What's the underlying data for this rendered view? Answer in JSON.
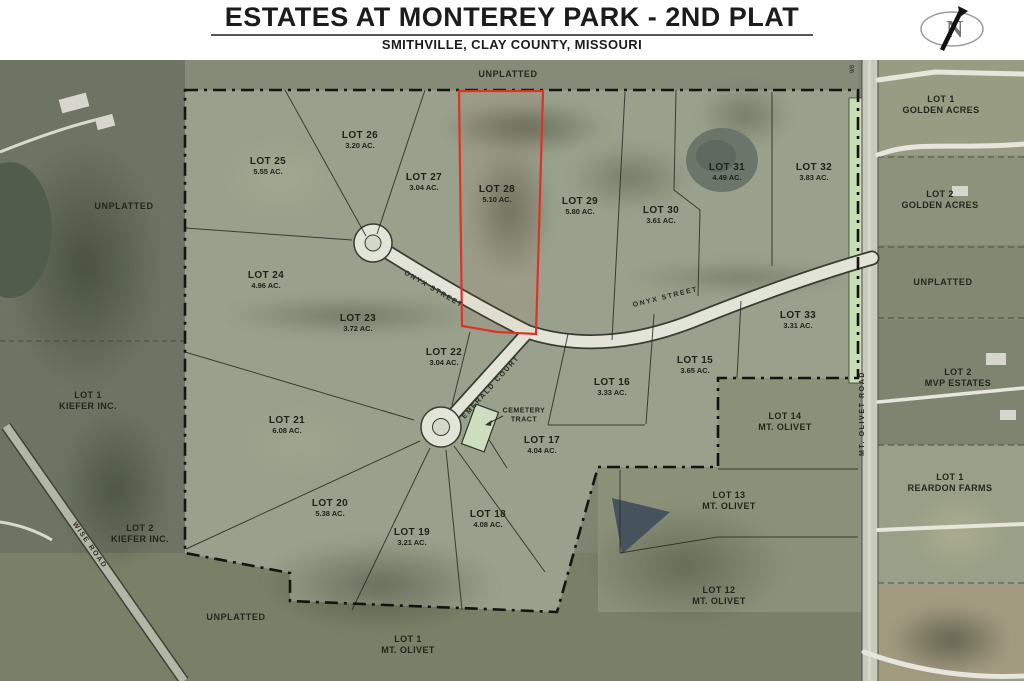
{
  "header": {
    "title": "ESTATES AT MONTEREY PARK - 2ND PLAT",
    "subtitle": "SMITHVILLE, CLAY COUNTY, MISSOURI",
    "compass_letter": "N"
  },
  "map": {
    "highlighted_lot": "LOT 28",
    "lots": [
      {
        "name": "LOT 25",
        "area": "5.55 AC."
      },
      {
        "name": "LOT 26",
        "area": "3.20 AC."
      },
      {
        "name": "LOT 27",
        "area": "3.04 AC."
      },
      {
        "name": "LOT 28",
        "area": "5.10 AC."
      },
      {
        "name": "LOT 29",
        "area": "5.80 AC."
      },
      {
        "name": "LOT 30",
        "area": "3.61 AC."
      },
      {
        "name": "LOT 31",
        "area": "4.49 AC."
      },
      {
        "name": "LOT 32",
        "area": "3.83 AC."
      },
      {
        "name": "LOT 33",
        "area": "3.31 AC."
      },
      {
        "name": "LOT 24",
        "area": "4.96 AC."
      },
      {
        "name": "LOT 23",
        "area": "3.72 AC."
      },
      {
        "name": "LOT 22",
        "area": "3.04 AC."
      },
      {
        "name": "LOT 21",
        "area": "6.08 AC."
      },
      {
        "name": "LOT 20",
        "area": "5.38 AC."
      },
      {
        "name": "LOT 19",
        "area": "3.21 AC."
      },
      {
        "name": "LOT 18",
        "area": "4.08 AC."
      },
      {
        "name": "LOT 17",
        "area": "4.04 AC."
      },
      {
        "name": "LOT 16",
        "area": "3.33 AC."
      },
      {
        "name": "LOT 15",
        "area": "3.65 AC."
      }
    ],
    "outside": [
      {
        "l1": "LOT 14",
        "l2": "MT. OLIVET"
      },
      {
        "l1": "LOT 13",
        "l2": "MT. OLIVET"
      },
      {
        "l1": "LOT 12",
        "l2": "MT. OLIVET"
      },
      {
        "l1": "LOT 1",
        "l2": "MT. OLIVET"
      },
      {
        "l1": "LOT 1",
        "l2": "GOLDEN ACRES"
      },
      {
        "l1": "LOT 2",
        "l2": "GOLDEN ACRES"
      },
      {
        "l1": "LOT 2",
        "l2": "MVP ESTATES"
      },
      {
        "l1": "LOT 1",
        "l2": "REARDON FARMS"
      },
      {
        "l1": "LOT 1",
        "l2": "KIEFER INC."
      },
      {
        "l1": "LOT 2",
        "l2": "KIEFER INC."
      }
    ],
    "unplatted_label": "UNPLATTED",
    "streets": {
      "onyx": "ONYX  STREET",
      "emerald": "EMERALD  COURT",
      "mt_olivet": "MT. OLIVET  ROAD",
      "wise": "WISE ROAD"
    },
    "cemetery": {
      "line1": "CEMETERY",
      "line2": "TRACT"
    },
    "road_marker": "9/6"
  },
  "colors": {
    "highlight_red": "#e03127",
    "plat_fill": "#99a08b",
    "street_fill": "#e1e4d6",
    "road_green_strip": "#c9ddb5",
    "boundary_black": "#141414",
    "aerial_base": "#7f8572"
  }
}
